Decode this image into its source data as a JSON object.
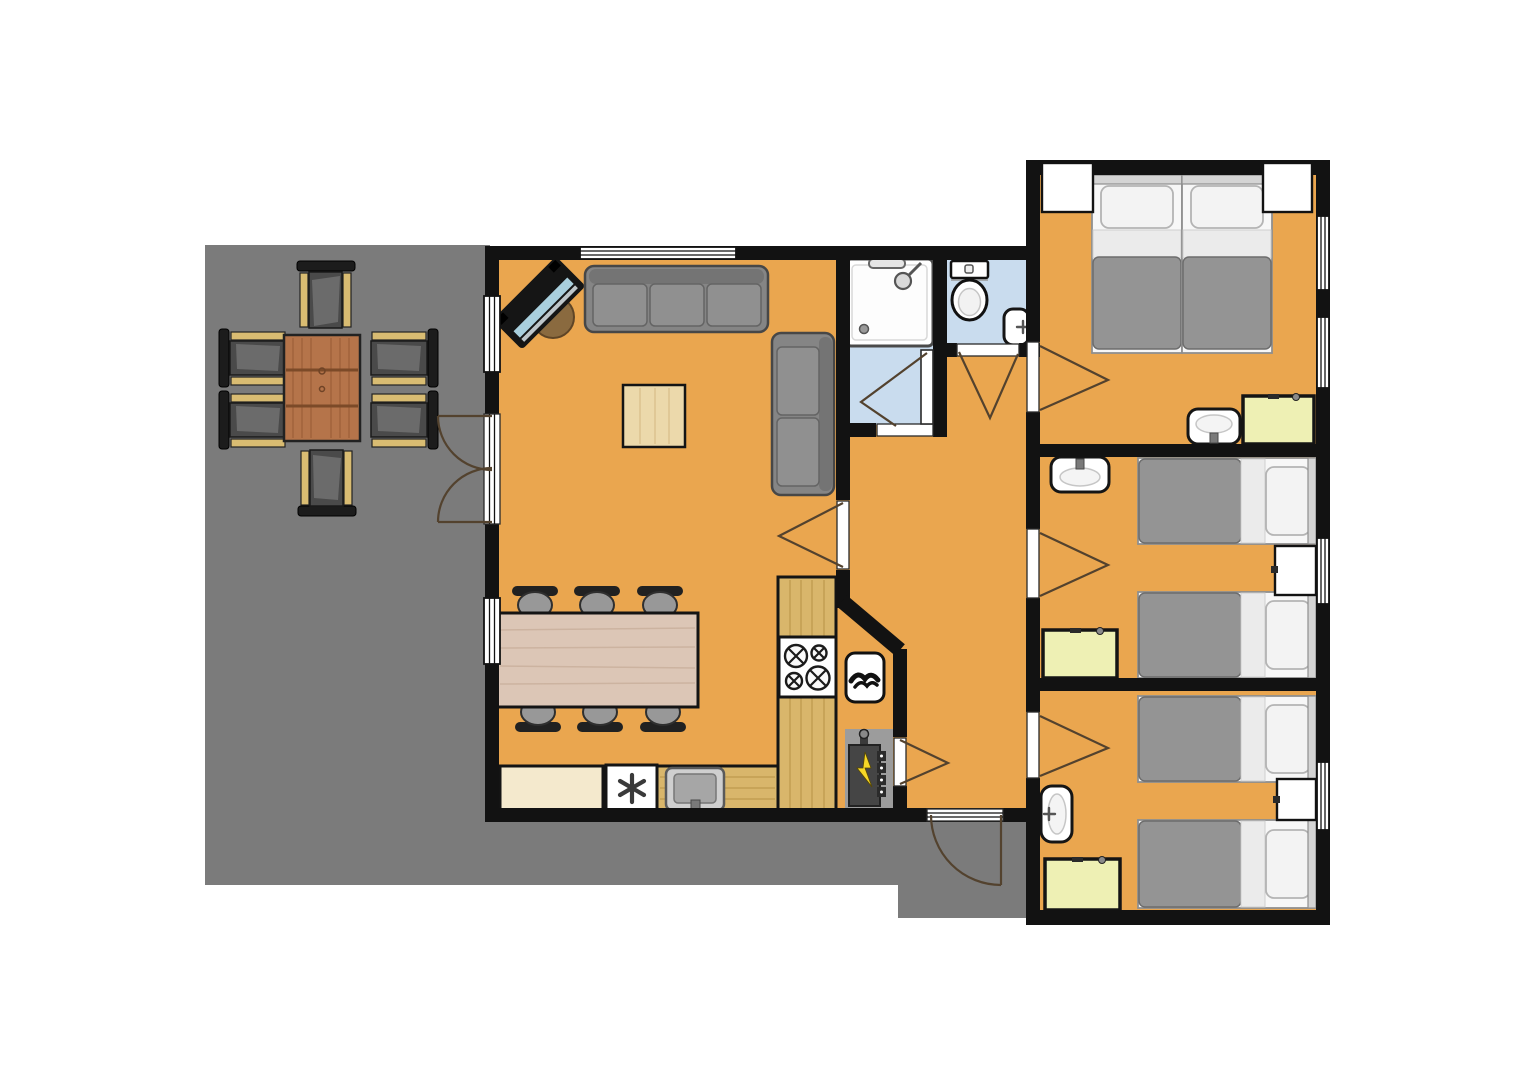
{
  "meta": {
    "title": "Holiday home floor plan",
    "description": "Top-down floor plan: terrace with outdoor dining set, living room with sofas and TV, dining table with six chairs, kitchen with hob, sink and dishwasher, shower room, toilet room, hallway with technical closet, and three bedrooms each with beds, washbasin and wardrobe"
  },
  "palette": {
    "wall": "#121212",
    "floor": "#eaa64f",
    "terrace": "#7b7b7b",
    "wet_floor": "#c9dcee",
    "door_arc": "#53422e",
    "counter_wood": "#d9b66b",
    "counter_wood_grain": "#c09a4f",
    "counter_cream": "#f4e9cd",
    "table_wood": "#dcc6b6",
    "table_wood_grain": "#cbb19e",
    "coffee_table": "#ecd9ab",
    "outdoor_table": "#b5744a",
    "chair_dark": "#4a4a4a",
    "chair_back": "#212121",
    "armrest_wood": "#d9bc72",
    "sofa": "#858585",
    "bed_duvet": "#949494",
    "cabinet": "#eef0b4",
    "panel_gray": "#9c9c9c",
    "panel_dark": "#454545",
    "lightning": "#f7d827",
    "tv_screen": "#a9cfdd",
    "tv_stand": "#8a6a3f",
    "fixture_stroke": "#151515"
  },
  "rooms": [
    {
      "name": "Terrace",
      "furniture": [
        "outdoor dining table",
        "6 garden chairs"
      ]
    },
    {
      "name": "Living room",
      "furniture": [
        "corner TV",
        "3-seat sofa",
        "2-seat sofa",
        "coffee table",
        "dining table",
        "6 dining chairs"
      ]
    },
    {
      "name": "Kitchen",
      "furniture": [
        "L-shaped wood counter",
        "4-burner hob",
        "sink",
        "dishwasher"
      ]
    },
    {
      "name": "Shower room",
      "furniture": [
        "shower"
      ]
    },
    {
      "name": "Toilet room",
      "furniture": [
        "toilet",
        "hand basin"
      ]
    },
    {
      "name": "Hallway",
      "furniture": [
        "entrance door"
      ]
    },
    {
      "name": "Technical closet",
      "furniture": [
        "ventilation unit",
        "electrical panel"
      ]
    },
    {
      "name": "Bedroom 1",
      "furniture": [
        "double bed (two singles)",
        "washbasin",
        "wardrobe"
      ]
    },
    {
      "name": "Bedroom 2",
      "furniture": [
        "2 single beds",
        "washbasin",
        "wardrobe"
      ]
    },
    {
      "name": "Bedroom 3",
      "furniture": [
        "2 single beds",
        "washbasin",
        "wardrobe"
      ]
    }
  ]
}
